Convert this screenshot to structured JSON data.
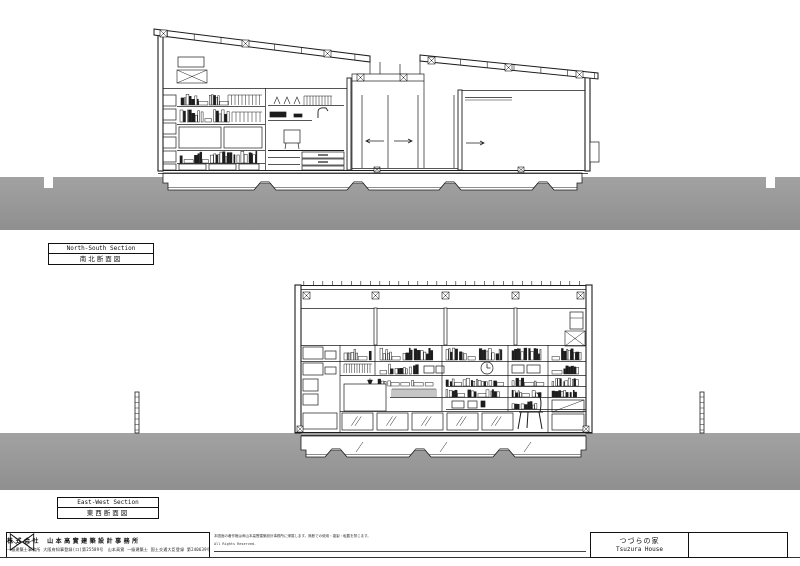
{
  "page": {
    "background": "#ffffff",
    "line_color": "#1c1c1c",
    "ground_color_top": "#a2a2a2",
    "ground_color_bottom": "#8f8f8f"
  },
  "sections": {
    "north_south": {
      "label_en": "North-South Section",
      "label_ja": "南北断面図"
    },
    "east_west": {
      "label_en": "East-West Section",
      "label_ja": "東西断面図"
    }
  },
  "title_block": {
    "logo": "bowtie-logo",
    "company": "株式会社 山本高實建築設計事務所",
    "registration": "一級建築士事務所 大阪府知事登録(ロ)第25589号　山本高實 一級建築士 国土交通大臣登録 第240639号",
    "notice_ja": "本図面の著作権は㈱山本高實建築設計事務所に帰属します。無断での使用・複製・転載を禁じます。",
    "notice_en": "All Rights Reserved.",
    "project_name_ja": "つづらの家",
    "project_name_en": "Tsuzura House"
  }
}
